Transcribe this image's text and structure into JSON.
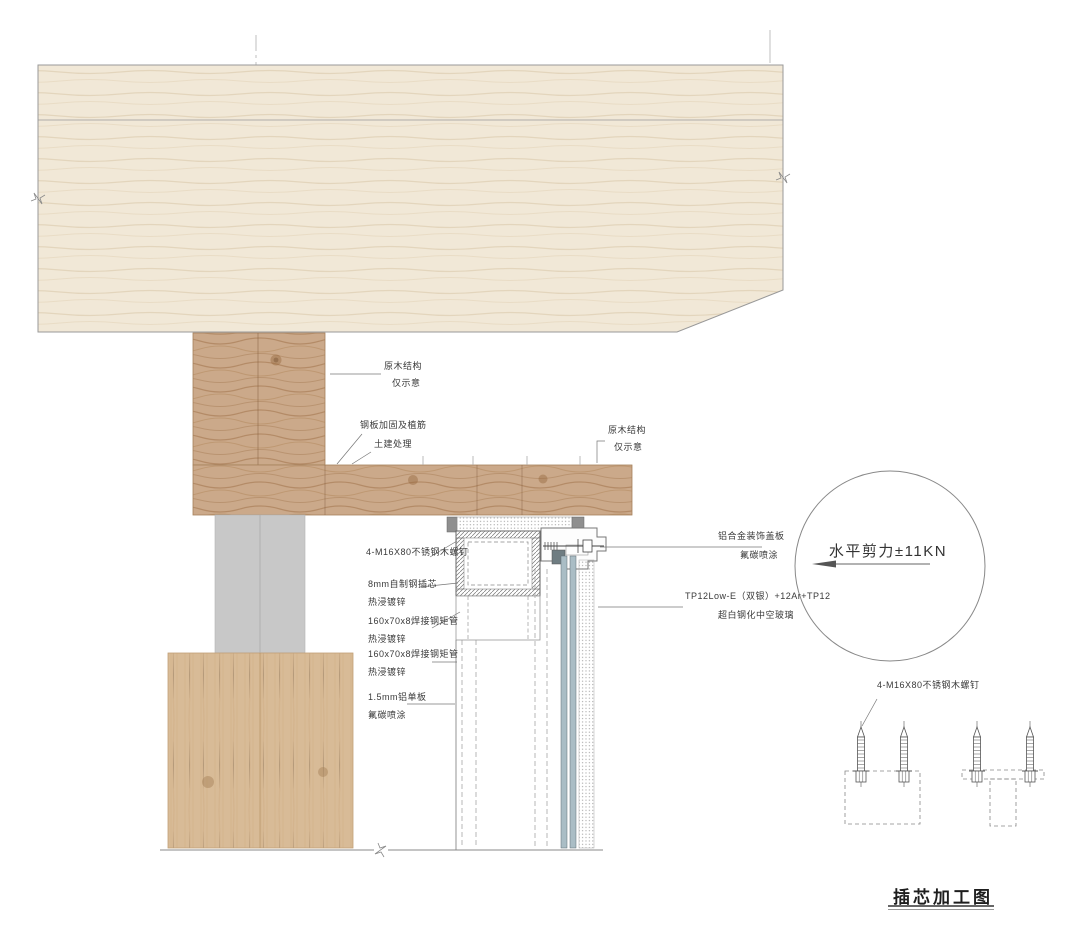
{
  "drawing": {
    "notes": {
      "timber_top_l1": "原木结构",
      "timber_top_l2": "仅示意",
      "steel_plate_l1": "钢板加固及植筋",
      "steel_plate_l2": "土建处理",
      "timber_right_l1": "原木结构",
      "timber_right_l2": "仅示意"
    },
    "left_labels": {
      "screw": "4-M16X80不锈钢木螺钉",
      "core_l1": "8mm自制钢插芯",
      "core_l2": "热浸镀锌",
      "tube1_l1": "160x70x8焊接钢矩管",
      "tube1_l2": "热浸镀锌",
      "tube2_l1": "160x70x8焊接钢矩管",
      "tube2_l2": "热浸镀锌",
      "alum_l1": "1.5mm铝单板",
      "alum_l2": "氟碳喷涂"
    },
    "right_labels": {
      "cover_l1": "铝合金装饰盖板",
      "cover_l2": "氟碳喷涂",
      "glass_l1": "TP12Low-E（双银）+12Ar+TP12",
      "glass_l2": "超白钢化中空玻璃"
    },
    "shear_note": "水平剪力±11KN",
    "insert_screw_label": "4-M16X80不锈钢木螺钉",
    "title": "插芯加工图"
  },
  "colors": {
    "slab_wood": "#f1e8d7",
    "wavy_wood": "#cba98a",
    "base_wood": "#d8bb97",
    "concrete": "#c8c8c8",
    "glass": "#aabdc5",
    "line": "#4a4a4a"
  }
}
